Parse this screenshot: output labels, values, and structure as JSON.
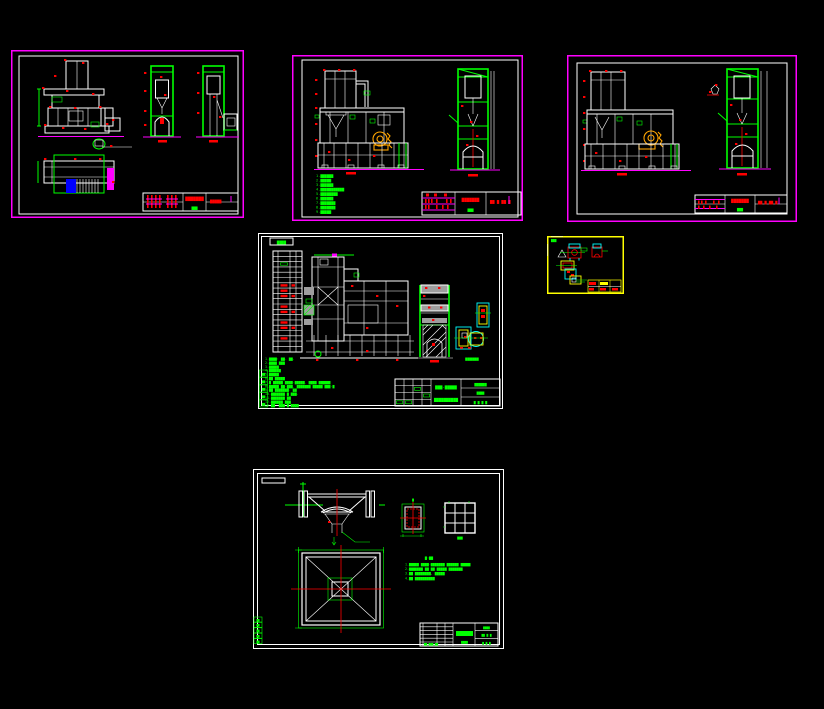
{
  "app": {
    "background": "#000000",
    "description": "CAD workspace with six mechanical drawing sheets"
  },
  "colors": {
    "sheet_border_magenta": "#FF00FF",
    "sheet_border_white": "#FFFFFF",
    "sheet_border_yellow": "#FFFF00",
    "line_white": "#FFFFFF",
    "line_green": "#00FF00",
    "line_red": "#FF0000",
    "line_cyan": "#00FFFF",
    "line_orange": "#FFA500",
    "fill_blue": "#0000FF",
    "fill_gray": "#9E9E9E"
  },
  "sheets": [
    {
      "name": "sheet-1-elevation-and-plan",
      "title_block": {
        "title": "▇▇▇▇▇▇▇",
        "subtitle": "▇▇▇",
        "code": "▇▇▇▇▇"
      }
    },
    {
      "name": "sheet-2-elevation-with-notes",
      "notes": [
        "1.▇▇▇▇▇▇",
        "2.▇▇▇▇▇",
        "3.▇▇▇▇▇▇",
        "4.▇▇▇▇▇▇▇▇▇▇▇",
        "5.▇▇▇▇▇▇▇▇",
        "6.▇▇▇▇▇▇",
        "7.▇▇▇▇▇▇▇",
        "8.▇▇▇▇▇▇▇",
        "9.▇▇▇▇▇"
      ],
      "title_block": {
        "title": "▇▇▇▇▇▇▇",
        "subtitle": "▇▇▇",
        "code": "▇▇ ▇ ▇▇ ▇"
      }
    },
    {
      "name": "sheet-3-elevation",
      "title_block": {
        "title": "▇▇▇▇▇▇▇",
        "subtitle": "▇▇▇",
        "code": "▇▇ ▇ ▇▇ ▇"
      }
    },
    {
      "name": "sheet-4-assembly",
      "parts_table_header": "▇▇▇▇",
      "detail_label": "▇▇▇▇▇▇▇",
      "notes": [
        "1.▇▇▇▇: ▇▇. ▇▇.",
        "2.▇▇▇▇ ▇▇▇",
        "3.▇▇▇▇▇",
        "4.▇▇▇▇▇▇",
        "5.▇▇▇▇▇",
        "6.▇▇ ▇▇▇▇▇",
        "7.▇ ▇▇▇▇▇ ▇▇▇▇-▇▇▇▇▇. ▇▇▇▇ ▇▇▇▇▇▇",
        "8.▇▇▇▇▇ ▇▇-▇▇▇. ▇▇▇▇▇▇▇ ▇▇▇▇▇ ▇▇▇-▇",
        "9.▇▇ ▇▇▇▇▇▇▇. ▇▇",
        "10.▇▇▇▇▇▇▇ ▇ ▇▇▇.",
        "11.▇▇▇▇▇▇▇ ▇▇",
        "12.▇▇▇▇▇▇ ▇▇▇",
        "13.▇▇. ▇▇▇ ▇.▇▇▇▇"
      ],
      "revision_cells": [
        "▇▇",
        "▇▇",
        "▇▇",
        "▇▇",
        "▇▇"
      ],
      "title_block": {
        "center_top": "▇▇▇-▇▇▇▇▇",
        "center_bottom": "▇▇▇▇▇▇▇▇▇▇",
        "right_top": "▇▇▇▇▇▇",
        "right_mid": "▇▇▇▇",
        "right_bottom": "▇ ▇ ▇ ▇"
      }
    },
    {
      "name": "sheet-5-small-details",
      "corner_label": "▇▇▇"
    },
    {
      "name": "sheet-6-hopper-foundation",
      "notes_heading": "▇:▇▇",
      "notes": [
        "1.▇▇▇▇▇ ▇▇▇▇-▇▇▇▇▇▇▇ ▇▇▇▇▇▇ ▇▇▇▇▇",
        "2.▇▇▇▇▇▇▇ ▇▇ ▇▇ ▇▇▇▇▇ ▇▇▇▇▇▇▇",
        "3.▇▇ ▇▇▇▇▇▇▇▇, ▇▇▇▇▇",
        "4.▇▇ ▇▇▇▇▇▇▇▇▇▇"
      ],
      "detail_label": "▇",
      "grid_label": "▇▇▇",
      "revision_cells": [
        "▇▇",
        "▇▇",
        "▇▇",
        "▇▇",
        "▇▇"
      ],
      "title_block": {
        "badge": "▇▇▇▇",
        "left_row": "▇▇ ▇▇▇ ▇▇",
        "right_top": "▇▇▇▇",
        "right_mid": "▇▇ ▇ ▇",
        "right_bottom": "▇ ▇ ▇"
      }
    }
  ]
}
